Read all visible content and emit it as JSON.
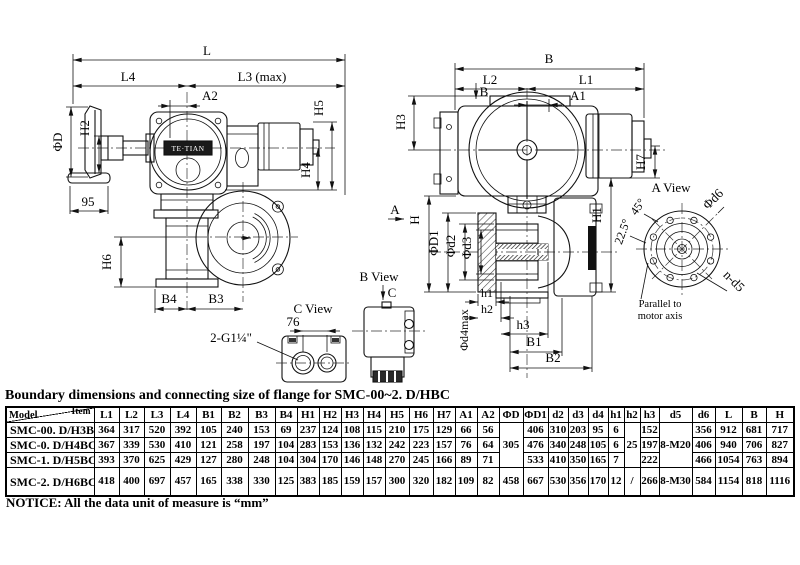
{
  "title": "Boundary dimensions and connecting size of flange for SMC-00~2. D/HBC",
  "notice": "NOTICE: All the data unit of measure is  “mm”",
  "labels": {
    "L": "L",
    "L4": "L4",
    "L3max": "L3 (max)",
    "A2": "A2",
    "phiD": "ΦD",
    "H2": "H2",
    "n95": "95",
    "H5": "H5",
    "H4": "H4",
    "H6": "H6",
    "B4": "B4",
    "B3": "B3",
    "thread": "2-G1¼\"",
    "viewC": "C View",
    "n76": "76",
    "viewB": "B View",
    "arrowC": "C",
    "B": "B",
    "L2": "L2",
    "L1": "L1",
    "A1": "A1",
    "arrowB": "B",
    "H3": "H3",
    "H": "H",
    "phiD1": "ΦD1",
    "phid2": "Φd2",
    "phid3": "Φd3",
    "h1": "h1",
    "h2": "h2",
    "h3": "h3",
    "B1": "B1",
    "B2": "B2",
    "phid4max": "Φd4max",
    "H1": "H1",
    "H7": "H7",
    "viewA": "A View",
    "phid6": "Φd6",
    "deg45": "45°",
    "deg225": "22.5°",
    "nd5": "n-d5",
    "parallel1": "Parallel to",
    "parallel2": "motor axis",
    "arrowA": "A",
    "nameplate": "TE·TIAN"
  },
  "table": {
    "corner_top": "Item",
    "corner_bottom": "Model",
    "columns": [
      "L1",
      "L2",
      "L3",
      "L4",
      "B1",
      "B2",
      "B3",
      "B4",
      "H1",
      "H2",
      "H3",
      "H4",
      "H5",
      "H6",
      "H7",
      "A1",
      "A2",
      "ΦD",
      "ΦD1",
      "d2",
      "d3",
      "d4",
      "h1",
      "h2",
      "h3",
      "d5",
      "d6",
      "L",
      "B",
      "H"
    ],
    "col_widths": [
      88,
      25,
      25,
      26,
      26,
      25,
      27,
      27,
      22,
      22,
      22,
      22,
      22,
      24,
      24,
      22,
      22,
      22,
      24,
      25,
      20,
      20,
      20,
      16,
      16,
      19,
      33,
      23,
      27,
      24,
      28
    ],
    "rows": [
      {
        "model": "SMC-00. D/H3BC",
        "values": [
          "364",
          "317",
          "520",
          "392",
          "105",
          "240",
          "153",
          "69",
          "237",
          "124",
          "108",
          "115",
          "210",
          "175",
          "129",
          "66",
          "56",
          "305",
          "406",
          "310",
          "203",
          "95",
          "6",
          "25",
          "152",
          "8-M20",
          "356",
          "912",
          "681",
          "717"
        ]
      },
      {
        "model": "SMC-0. D/H4BC",
        "values": [
          "367",
          "339",
          "530",
          "410",
          "121",
          "258",
          "197",
          "104",
          "283",
          "153",
          "136",
          "132",
          "242",
          "223",
          "157",
          "76",
          "64",
          null,
          "476",
          "340",
          "248",
          "105",
          "6",
          null,
          "197",
          null,
          "406",
          "940",
          "706",
          "827"
        ]
      },
      {
        "model": "SMC-1. D/H5BC",
        "values": [
          "393",
          "370",
          "625",
          "429",
          "127",
          "280",
          "248",
          "104",
          "304",
          "170",
          "146",
          "148",
          "270",
          "245",
          "166",
          "89",
          "71",
          null,
          "533",
          "410",
          "350",
          "165",
          "7",
          null,
          "222",
          null,
          "466",
          "1054",
          "763",
          "894"
        ]
      },
      {
        "model": "SMC-2. D/H6BC",
        "values": [
          "418",
          "400",
          "697",
          "457",
          "165",
          "338",
          "330",
          "125",
          "383",
          "185",
          "159",
          "157",
          "300",
          "320",
          "182",
          "109",
          "82",
          "458",
          "667",
          "530",
          "356",
          "170",
          "12",
          "/",
          "266",
          "8-M30",
          "584",
          "1154",
          "818",
          "1116"
        ]
      }
    ],
    "merges": [
      {
        "row": 0,
        "col": 17,
        "rowspan": 3
      },
      {
        "row": 0,
        "col": 23,
        "rowspan": 3
      },
      {
        "row": 0,
        "col": 25,
        "rowspan": 3
      }
    ]
  }
}
